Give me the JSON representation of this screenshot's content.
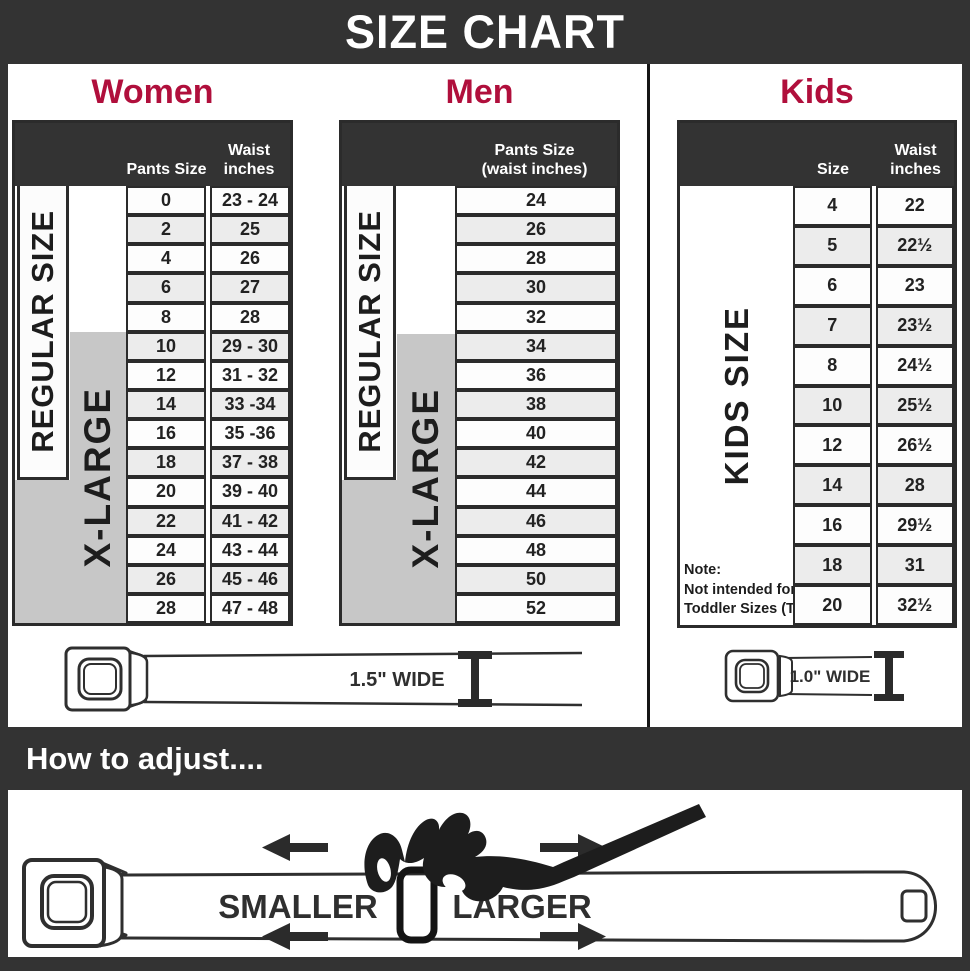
{
  "title": "SIZE CHART",
  "colors": {
    "charcoal": "#333333",
    "crimson": "#b00f3c",
    "gray_band": "#c7c7c7",
    "row_alt": "#ececec",
    "line": "#2b2b2b"
  },
  "women": {
    "heading": "Women",
    "header_col1": "Pants Size",
    "header_col2": "Waist inches",
    "regular_label": "REGULAR SIZE",
    "xlarge_label": "X-LARGE",
    "rows": [
      {
        "size": "0",
        "waist": "23 - 24"
      },
      {
        "size": "2",
        "waist": "25"
      },
      {
        "size": "4",
        "waist": "26"
      },
      {
        "size": "6",
        "waist": "27"
      },
      {
        "size": "8",
        "waist": "28"
      },
      {
        "size": "10",
        "waist": "29 - 30"
      },
      {
        "size": "12",
        "waist": "31 - 32"
      },
      {
        "size": "14",
        "waist": "33 -34"
      },
      {
        "size": "16",
        "waist": "35 -36"
      },
      {
        "size": "18",
        "waist": "37 - 38"
      },
      {
        "size": "20",
        "waist": "39 - 40"
      },
      {
        "size": "22",
        "waist": "41 - 42"
      },
      {
        "size": "24",
        "waist": "43 - 44"
      },
      {
        "size": "26",
        "waist": "45 - 46"
      },
      {
        "size": "28",
        "waist": "47 - 48"
      }
    ]
  },
  "men": {
    "heading": "Men",
    "header_line1": "Pants Size",
    "header_line2": "(waist inches)",
    "regular_label": "REGULAR SIZE",
    "xlarge_label": "X-LARGE",
    "rows": [
      "24",
      "26",
      "28",
      "30",
      "32",
      "34",
      "36",
      "38",
      "40",
      "42",
      "44",
      "46",
      "48",
      "50",
      "52"
    ]
  },
  "kids": {
    "heading": "Kids",
    "header_col1": "Size",
    "header_col2": "Waist inches",
    "side_label": "KIDS SIZE",
    "note_line1": "Note:",
    "note_line2": "Not intended for",
    "note_line3": "Toddler Sizes (T)",
    "rows": [
      {
        "size": "4",
        "waist": "22"
      },
      {
        "size": "5",
        "waist": "22½"
      },
      {
        "size": "6",
        "waist": "23"
      },
      {
        "size": "7",
        "waist": "23½"
      },
      {
        "size": "8",
        "waist": "24½"
      },
      {
        "size": "10",
        "waist": "25½"
      },
      {
        "size": "12",
        "waist": "26½"
      },
      {
        "size": "14",
        "waist": "28"
      },
      {
        "size": "16",
        "waist": "29½"
      },
      {
        "size": "18",
        "waist": "31"
      },
      {
        "size": "20",
        "waist": "32½"
      }
    ]
  },
  "belts": {
    "adult_width_label": "1.5\" WIDE",
    "kids_width_label": "1.0\" WIDE"
  },
  "adjust": {
    "heading": "How to adjust....",
    "smaller_label": "SMALLER",
    "larger_label": "LARGER"
  }
}
